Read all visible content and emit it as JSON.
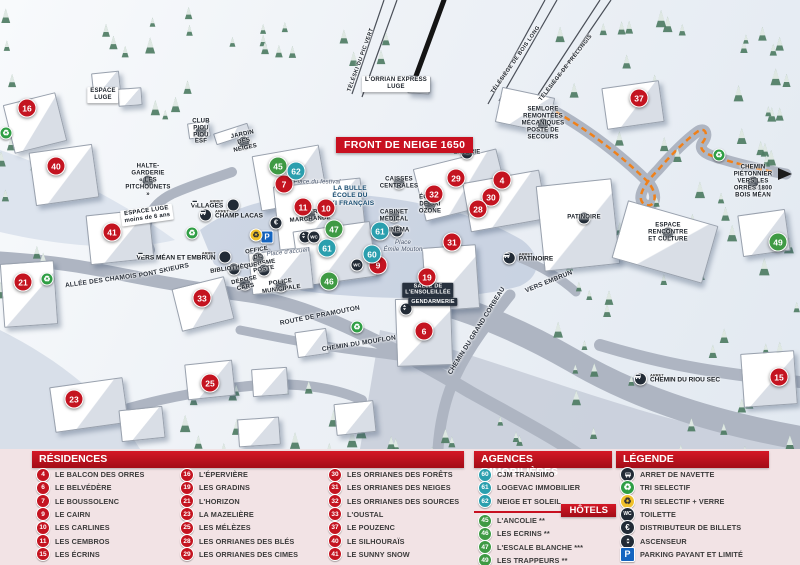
{
  "banner": {
    "text": "FRONT DE NEIGE 1650"
  },
  "colors": {
    "residence": "#c41420",
    "hotel": "#3f9a44",
    "agency": "#2b9fae",
    "accent": "#c81020",
    "trail": "#f08019"
  },
  "map": {
    "markers": [
      {
        "num": "16",
        "type": "residence",
        "x": 27,
        "y": 108
      },
      {
        "num": "40",
        "type": "residence",
        "x": 56,
        "y": 166
      },
      {
        "num": "41",
        "type": "residence",
        "x": 112,
        "y": 232
      },
      {
        "num": "21",
        "type": "residence",
        "x": 23,
        "y": 282
      },
      {
        "num": "33",
        "type": "residence",
        "x": 202,
        "y": 298
      },
      {
        "num": "23",
        "type": "residence",
        "x": 74,
        "y": 399
      },
      {
        "num": "25",
        "type": "residence",
        "x": 210,
        "y": 383
      },
      {
        "num": "7",
        "type": "residence",
        "x": 284,
        "y": 184
      },
      {
        "num": "11",
        "type": "residence",
        "x": 303,
        "y": 207
      },
      {
        "num": "10",
        "type": "residence",
        "x": 326,
        "y": 208
      },
      {
        "num": "9",
        "type": "residence",
        "x": 378,
        "y": 265
      },
      {
        "num": "19",
        "type": "residence",
        "x": 427,
        "y": 277
      },
      {
        "num": "6",
        "type": "residence",
        "x": 424,
        "y": 331
      },
      {
        "num": "29",
        "type": "residence",
        "x": 456,
        "y": 178
      },
      {
        "num": "4",
        "type": "residence",
        "x": 502,
        "y": 180
      },
      {
        "num": "32",
        "type": "residence",
        "x": 434,
        "y": 194
      },
      {
        "num": "30",
        "type": "residence",
        "x": 491,
        "y": 197
      },
      {
        "num": "28",
        "type": "residence",
        "x": 478,
        "y": 209
      },
      {
        "num": "31",
        "type": "residence",
        "x": 452,
        "y": 242
      },
      {
        "num": "37",
        "type": "residence",
        "x": 639,
        "y": 98
      },
      {
        "num": "15",
        "type": "residence",
        "x": 779,
        "y": 377
      },
      {
        "num": "45",
        "type": "hotel",
        "x": 278,
        "y": 166
      },
      {
        "num": "47",
        "type": "hotel",
        "x": 334,
        "y": 229
      },
      {
        "num": "46",
        "type": "hotel",
        "x": 329,
        "y": 281
      },
      {
        "num": "49",
        "type": "hotel",
        "x": 778,
        "y": 242
      },
      {
        "num": "62",
        "type": "agency",
        "x": 296,
        "y": 171
      },
      {
        "num": "61",
        "type": "agency",
        "x": 380,
        "y": 231
      },
      {
        "num": "61",
        "type": "agency",
        "x": 327,
        "y": 248
      },
      {
        "num": "60",
        "type": "agency",
        "x": 372,
        "y": 254
      }
    ],
    "bus_stops": [
      {
        "tag": "ARRET",
        "name": "VILLAGES",
        "x": 215,
        "y": 205,
        "side": "left"
      },
      {
        "tag": "ARRET",
        "name": "CHAMP LACAS",
        "x": 231,
        "y": 215,
        "side": "right"
      },
      {
        "tag": "ARRET",
        "name": "VERS MÉAN ET EMBRUN",
        "x": 184,
        "y": 257,
        "side": "left"
      },
      {
        "tag": "ARRET",
        "name": "PATINOIRE",
        "x": 528,
        "y": 258,
        "side": "right"
      },
      {
        "tag": "ARRET",
        "name": "CHEMIN DU RIOU SEC",
        "x": 677,
        "y": 379,
        "side": "right"
      }
    ],
    "poi_icons": [
      {
        "icon": "euro-icon",
        "x": 276,
        "y": 223
      },
      {
        "icon": "parking-icon",
        "x": 267,
        "y": 237
      },
      {
        "icon": "recycle-verre-icon",
        "x": 256,
        "y": 235
      },
      {
        "icon": "elevator-icon",
        "x": 305,
        "y": 237
      },
      {
        "icon": "wc-icon",
        "x": 314,
        "y": 237
      },
      {
        "icon": "wc-icon",
        "x": 357,
        "y": 265
      },
      {
        "icon": "elevator-icon",
        "x": 406,
        "y": 309
      },
      {
        "icon": "recycle-icon",
        "x": 192,
        "y": 233
      },
      {
        "icon": "recycle-icon",
        "x": 47,
        "y": 279
      },
      {
        "icon": "recycle-icon",
        "x": 357,
        "y": 327
      },
      {
        "icon": "recycle-icon",
        "x": 719,
        "y": 155
      },
      {
        "icon": "recycle-icon",
        "x": 6,
        "y": 133
      }
    ],
    "labels": [
      {
        "cls": "lift",
        "text": "TÉLÉSKI DU PIC VERT",
        "x": 361,
        "y": 60,
        "rot": -70
      },
      {
        "cls": "lift",
        "text": "TÉLÉSIÈGE DE BOIS LONG",
        "x": 516,
        "y": 60,
        "rot": -55
      },
      {
        "cls": "lift",
        "text": "TÉLÉSIÈGE DE PRÉLONGIS",
        "x": 566,
        "y": 68,
        "rot": -52
      },
      {
        "cls": "chip",
        "text": "L'ORRIAN EXPRESS\nLUGE",
        "x": 396,
        "y": 84,
        "rot": 0
      },
      {
        "cls": "poi",
        "text": "SEMLORE\nREMONTÉES MÉCANIQUES\nPOSTE DE SECOURS",
        "x": 543,
        "y": 124,
        "rot": 0
      },
      {
        "cls": "poi",
        "text": "CHEMIN PIÉTONNIER\nVERS LES ORRES 1800\nBOIS MÉAN",
        "x": 753,
        "y": 182,
        "rot": 0
      },
      {
        "cls": "poi",
        "text": "CLUB\nPIOU PIOU ESF",
        "x": 201,
        "y": 132,
        "rot": 0
      },
      {
        "cls": "poi",
        "text": "JARDIN DES NEIGES",
        "x": 244,
        "y": 142,
        "rot": -12
      },
      {
        "cls": "poi",
        "text": "HALTE-GARDERIE\n« LES PITCHOUNETS »",
        "x": 148,
        "y": 181,
        "rot": 0
      },
      {
        "cls": "chip",
        "text": "ESPACE\nLUGE",
        "x": 103,
        "y": 95,
        "rot": 0
      },
      {
        "cls": "chip",
        "text": "ESPACE LUGE\nmoins de 6 ans",
        "x": 147,
        "y": 215,
        "rot": -8
      },
      {
        "cls": "road",
        "text": "ALLÉE DES CHAMOIS",
        "x": 101,
        "y": 281,
        "rot": -8
      },
      {
        "cls": "road",
        "text": "PONT SKIEURS",
        "x": 164,
        "y": 271,
        "rot": -12
      },
      {
        "cls": "road",
        "text": "ROUTE DE PRAMOUTON",
        "x": 320,
        "y": 316,
        "rot": -11
      },
      {
        "cls": "road",
        "text": "CHEMIN DU MOUFLON",
        "x": 359,
        "y": 344,
        "rot": -9
      },
      {
        "cls": "road",
        "text": "CHEMIN DU GRAND CORBEAU",
        "x": 477,
        "y": 331,
        "rot": -58
      },
      {
        "cls": "road",
        "text": "VERS EMBRUN",
        "x": 549,
        "y": 282,
        "rot": -22
      },
      {
        "cls": "poi",
        "text": "LAVERIE",
        "x": 467,
        "y": 153,
        "rot": 0
      },
      {
        "cls": "poi",
        "text": "CAISSES\nCENTRALES",
        "x": 399,
        "y": 183,
        "rot": 0
      },
      {
        "cls": "poi",
        "text": "ÉCOLE DE SKI\nOZONE",
        "x": 430,
        "y": 205,
        "rot": 0
      },
      {
        "cls": "poi",
        "text": "CABINET\nMÉDICAL",
        "x": 394,
        "y": 216,
        "rot": 0
      },
      {
        "cls": "poi",
        "text": "CINÉMA",
        "x": 397,
        "y": 231,
        "rot": 0
      },
      {
        "cls": "place",
        "text": "Place\nÉmile Mouton",
        "x": 403,
        "y": 247,
        "rot": 0
      },
      {
        "cls": "place",
        "text": "Place du festival",
        "x": 317,
        "y": 183,
        "rot": 0
      },
      {
        "cls": "place",
        "text": "Place d'accueil",
        "x": 288,
        "y": 253,
        "rot": -6
      },
      {
        "cls": "poi",
        "text": "GALERIE MARCHANDE",
        "x": 310,
        "y": 216,
        "rot": -4
      },
      {
        "cls": "navy",
        "text": "LA BULLE\nÉCOLE DU\nSKI FRANÇAIS",
        "x": 350,
        "y": 196,
        "rot": 0
      },
      {
        "cls": "poi",
        "text": "OFFICE DE TOURISME",
        "x": 258,
        "y": 258,
        "rot": -10
      },
      {
        "cls": "poi",
        "text": "BIBLIOTHÈQUE",
        "x": 234,
        "y": 269,
        "rot": -8
      },
      {
        "cls": "poi",
        "text": "POSTE",
        "x": 264,
        "y": 270,
        "rot": -10
      },
      {
        "cls": "poi",
        "text": "DÉPOSE CARS",
        "x": 245,
        "y": 284,
        "rot": -12
      },
      {
        "cls": "poi",
        "text": "POLICE\nMUNICIPALE",
        "x": 281,
        "y": 286,
        "rot": -8
      },
      {
        "cls": "dark-chip",
        "text": "SALLE DE\nL'ENSOLEILLÉE",
        "x": 428,
        "y": 290,
        "rot": 0
      },
      {
        "cls": "dark-chip",
        "text": "GENDARMERIE",
        "x": 433,
        "y": 302,
        "rot": 0
      },
      {
        "cls": "poi",
        "text": "PATINOIRE",
        "x": 584,
        "y": 218,
        "rot": 0
      },
      {
        "cls": "poi",
        "text": "ESPACE RENCONTRE\nET CULTURE",
        "x": 668,
        "y": 233,
        "rot": 0
      }
    ],
    "buildings": [
      [
        8,
        98,
        52,
        48,
        -14
      ],
      [
        32,
        148,
        62,
        52,
        -8
      ],
      [
        88,
        212,
        62,
        48,
        -6
      ],
      [
        2,
        262,
        52,
        62,
        -4
      ],
      [
        176,
        282,
        52,
        42,
        -14
      ],
      [
        52,
        382,
        72,
        44,
        -8
      ],
      [
        120,
        408,
        42,
        30,
        -6
      ],
      [
        186,
        362,
        46,
        34,
        -6
      ],
      [
        252,
        368,
        34,
        26,
        -4
      ],
      [
        296,
        330,
        30,
        24,
        -8
      ],
      [
        238,
        418,
        40,
        26,
        -4
      ],
      [
        335,
        402,
        38,
        30,
        -6
      ],
      [
        256,
        150,
        66,
        54,
        -10
      ],
      [
        276,
        182,
        86,
        62,
        -6
      ],
      [
        296,
        226,
        76,
        54,
        -8
      ],
      [
        250,
        250,
        60,
        40,
        -6
      ],
      [
        418,
        158,
        84,
        52,
        -14
      ],
      [
        466,
        176,
        76,
        48,
        -10
      ],
      [
        424,
        246,
        52,
        62,
        -4
      ],
      [
        396,
        298,
        54,
        66,
        -2
      ],
      [
        604,
        84,
        56,
        40,
        -8
      ],
      [
        498,
        92,
        52,
        34,
        12
      ],
      [
        740,
        212,
        46,
        40,
        -8
      ],
      [
        742,
        352,
        52,
        52,
        -4
      ],
      [
        540,
        182,
        74,
        84,
        -6
      ],
      [
        618,
        212,
        92,
        58,
        16
      ],
      [
        92,
        72,
        26,
        18,
        -6
      ],
      [
        118,
        88,
        22,
        16,
        -4
      ],
      [
        214,
        128,
        34,
        10,
        -18
      ],
      [
        188,
        122,
        20,
        14,
        -8
      ],
      [
        408,
        76,
        20,
        16,
        4
      ]
    ]
  },
  "legend": {
    "residences": {
      "title": "RÉSIDENCES",
      "items": [
        {
          "num": "4",
          "name": "LE BALCON DES ORRES"
        },
        {
          "num": "6",
          "name": "LE BELVÉDÈRE"
        },
        {
          "num": "7",
          "name": "LE BOUSSOLENC"
        },
        {
          "num": "9",
          "name": "LE CAIRN"
        },
        {
          "num": "10",
          "name": "LES CARLINES"
        },
        {
          "num": "11",
          "name": "LES CEMBROS"
        },
        {
          "num": "15",
          "name": "LES ÉCRINS"
        },
        {
          "num": "16",
          "name": "L'ÉPERVIÈRE"
        },
        {
          "num": "19",
          "name": "LES GRADINS"
        },
        {
          "num": "21",
          "name": "L'HORIZON"
        },
        {
          "num": "23",
          "name": "LA MAZELIÈRE"
        },
        {
          "num": "25",
          "name": "LES MÉLÈZES"
        },
        {
          "num": "28",
          "name": "LES ORRIANES DES BLÉS"
        },
        {
          "num": "29",
          "name": "LES ORRIANES DES CIMES"
        },
        {
          "num": "30",
          "name": "LES ORRIANES DES FORÊTS"
        },
        {
          "num": "31",
          "name": "LES ORRIANES DES NEIGES"
        },
        {
          "num": "32",
          "name": "LES ORRIANES DES SOURCES"
        },
        {
          "num": "33",
          "name": "L'OUSTAL"
        },
        {
          "num": "37",
          "name": "LE POUZENC"
        },
        {
          "num": "40",
          "name": "LE SILHOURAÏS"
        },
        {
          "num": "41",
          "name": "LE SUNNY SNOW"
        }
      ]
    },
    "agences": {
      "title": "AGENCES IMMOBILIÈRES",
      "items": [
        {
          "num": "60",
          "name": "CJM TRANSIMO"
        },
        {
          "num": "61",
          "name": "LOGEVAC IMMOBILIER"
        },
        {
          "num": "62",
          "name": "NEIGE ET SOLEIL"
        }
      ]
    },
    "hotels": {
      "title": "HÔTELS",
      "items": [
        {
          "num": "45",
          "name": "L'ANCOLIE **"
        },
        {
          "num": "46",
          "name": "LES ECRINS **"
        },
        {
          "num": "47",
          "name": "L'ESCALE BLANCHE ***"
        },
        {
          "num": "49",
          "name": "LES TRAPPEURS **"
        }
      ]
    },
    "legende": {
      "title": "LÉGENDE",
      "items": [
        {
          "icon": "bus-icon",
          "label": "ARRET DE NAVETTE"
        },
        {
          "icon": "recycle-icon",
          "label": "TRI SELECTIF"
        },
        {
          "icon": "recycle-verre-icon",
          "label": "TRI SELECTIF + VERRE"
        },
        {
          "icon": "wc-icon",
          "label": "TOILETTE"
        },
        {
          "icon": "euro-icon",
          "label": "DISTRIBUTEUR DE BILLETS"
        },
        {
          "icon": "elevator-icon",
          "label": "ASCENSEUR"
        },
        {
          "icon": "parking-icon",
          "label": "PARKING PAYANT ET LIMITÉ"
        }
      ]
    }
  }
}
